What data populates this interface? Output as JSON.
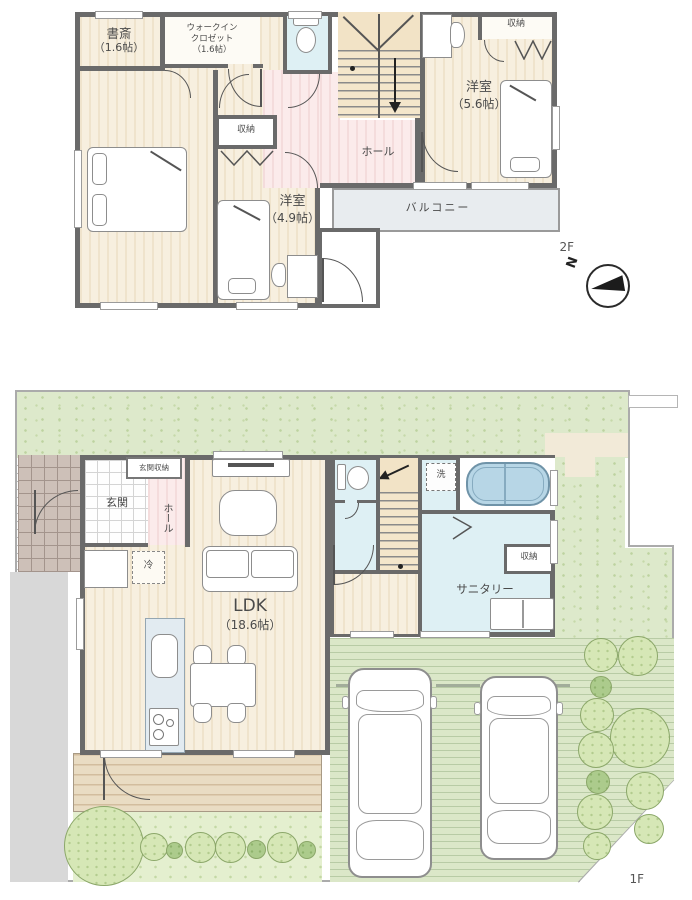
{
  "floor2": {
    "label": "2F",
    "study_name": "書斎",
    "study_size": "（1.6帖）",
    "wic_l1": "ウォークイン",
    "wic_l2": "クロゼット",
    "wic_size": "（1.6帖）",
    "closet_mid": "収納",
    "closet_right": "収納",
    "master_name": "主寝室",
    "master_size": "（8.7帖）",
    "west56_name": "洋室",
    "west56_size": "（5.6帖）",
    "west49_name": "洋室",
    "west49_size": "（4.9帖）",
    "hall": "ホール",
    "balcony": "バルコニー"
  },
  "floor1": {
    "label": "1F",
    "entrance_storage": "玄関収納",
    "entrance": "玄関",
    "hall": "ホール",
    "fridge": "冷",
    "ldk_name": "LDK",
    "ldk_size": "（18.6帖）",
    "washer": "洗",
    "sanitary": "サニタリー",
    "closet": "収納"
  },
  "compass": {
    "north": "N"
  },
  "colors": {
    "wall": "#6a6a6a",
    "floor_beige": "#f4ead7",
    "hall_pink": "#f8e4e4",
    "wet_blue": "#def0f4",
    "grass": "#dde9cb",
    "deck": "#e9dcc3",
    "bath_blue": "#b7d6e6",
    "balcony_gray": "#e8ecef"
  }
}
